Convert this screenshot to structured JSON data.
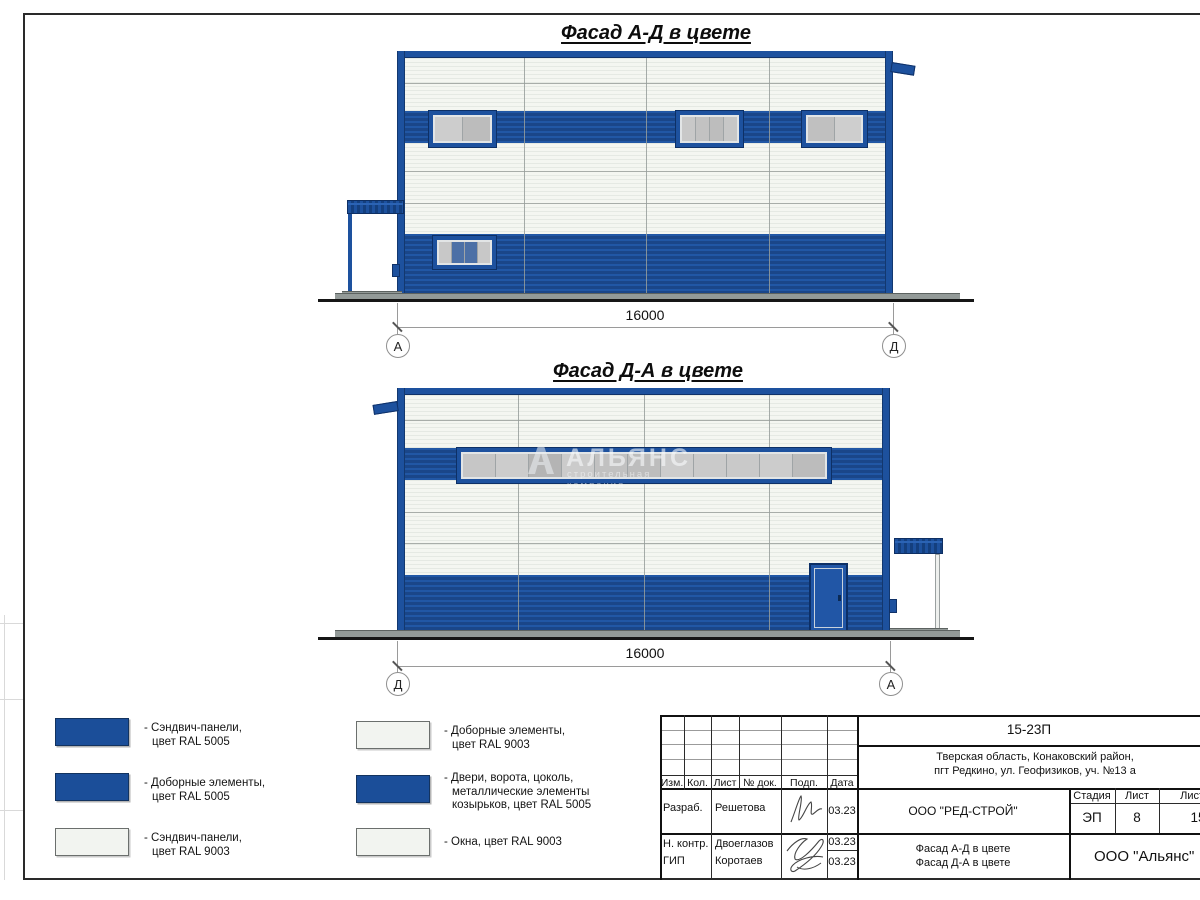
{
  "sheet": {
    "facades": [
      {
        "title": "Фасад А-Д в цвете",
        "dimension": "16000",
        "axis_left": "А",
        "axis_right": "Д"
      },
      {
        "title": "Фасад Д-А в цвете",
        "dimension": "16000",
        "axis_left": "Д",
        "axis_right": "А"
      }
    ],
    "watermark": {
      "name": "АЛЬЯНС",
      "tagline": "строительная компания"
    },
    "legend": {
      "left": [
        {
          "swatch": "blue",
          "lines": [
            "- Сэндвич-панели,",
            "цвет RAL 5005"
          ]
        },
        {
          "swatch": "blue",
          "lines": [
            "- Доборные элементы,",
            "цвет RAL 5005"
          ]
        },
        {
          "swatch": "white",
          "lines": [
            "- Сэндвич-панели,",
            "цвет RAL 9003"
          ]
        }
      ],
      "right": [
        {
          "swatch": "white",
          "lines": [
            "- Доборные элементы,",
            "цвет RAL 9003"
          ]
        },
        {
          "swatch": "blue",
          "lines": [
            "- Двери, ворота, цоколь,",
            "металлические элементы",
            "козырьков, цвет RAL 5005"
          ]
        },
        {
          "swatch": "white",
          "lines": [
            "- Окна, цвет RAL 9003"
          ]
        }
      ]
    },
    "colors": {
      "ral5005": "#1b4e99",
      "ral9003": "#f2f4f0",
      "window_pane_gray": "#c6c6c6",
      "window_pane_blue": "#4c70a6"
    },
    "titleblock": {
      "doc_number": "15-23П",
      "address_line1": "Тверская область, Конаковский район,",
      "address_line2": "пгт Редкино, ул. Геофизиков, уч. №13 а",
      "cols": {
        "izm": "Изм.",
        "kol": "Кол.",
        "list": "Лист",
        "doc": "№ док.",
        "podp": "Подп.",
        "data": "Дата"
      },
      "rows": [
        {
          "role": "Разраб.",
          "name": "Решетова",
          "date": "03.23"
        },
        {
          "role": "Н. контр.",
          "name": "Двоеглазов",
          "date": "03.23"
        },
        {
          "role": "ГИП",
          "name": "Коротаев",
          "date": "03.23"
        }
      ],
      "company": "ООО \"РЕД-СТРОЙ\"",
      "stage_label": "Стадия",
      "stage": "ЭП",
      "sheet_label": "Лист",
      "sheet": "8",
      "sheets_label": "Листов",
      "sheets": "15",
      "content_line1": "Фасад А-Д в цвете",
      "content_line2": "Фасад Д-А в цвете",
      "org": "ООО \"Альянс\""
    }
  }
}
